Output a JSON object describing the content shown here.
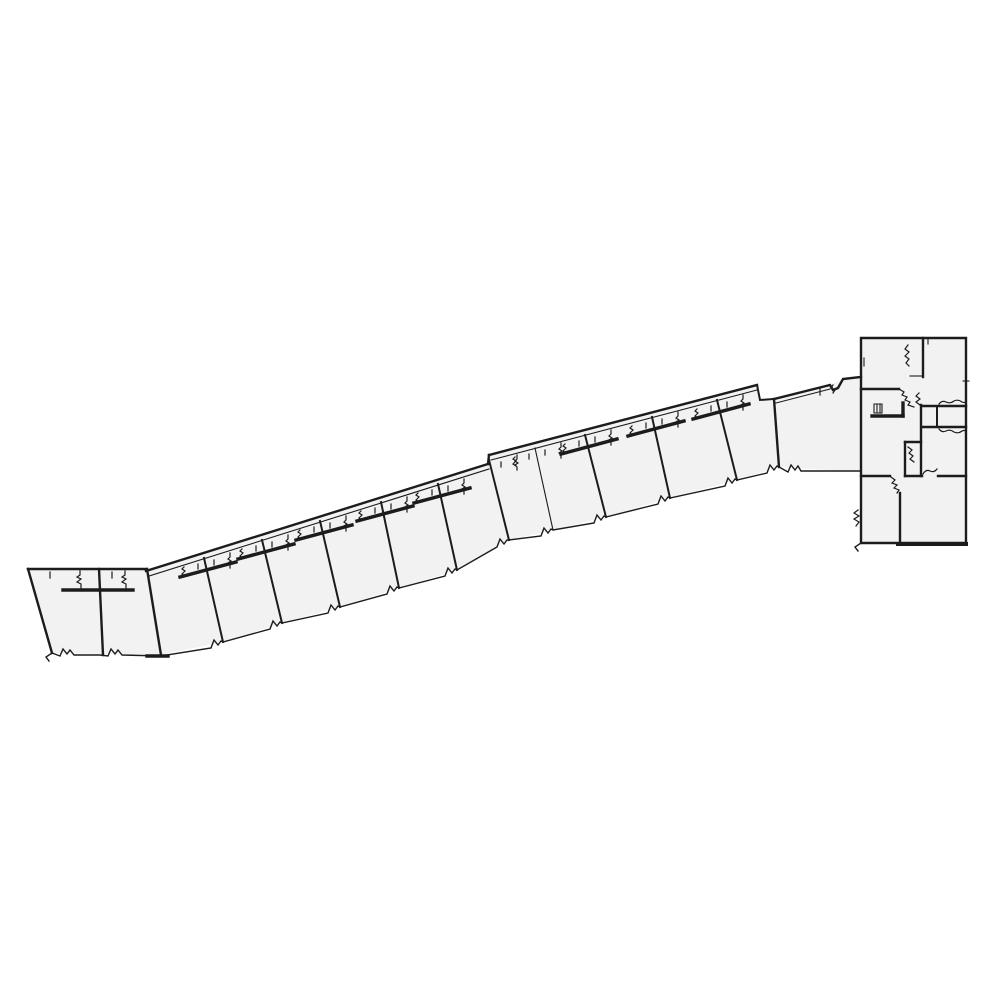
{
  "page": {
    "title": "architectural-floor-plan",
    "background": "#ffffff"
  },
  "drawing": {
    "stroke_color": "#1c1c1c",
    "fill_color": "#f2f2f2",
    "layers": [
      {
        "name": "unit-fill",
        "kind": "fill",
        "width": 0,
        "paths": [
          "M28,569 L147,569 L161,655 L52,653 Z",
          "M147,569 L488,464 L509,540 L457,570 L399,588 L340,607 L282,623 L223,642 L161,655 Z",
          "M489,455 L757,385 L760,400 L774,399 L779,467 L737,480 L670,498 L606,517 L553,530 L509,540 Z",
          "M774,399 L830,385 L843,379 L861,377 L861,472 L779,467 Z",
          "M861,338 L966,338 L966,543 L861,543 Z"
        ]
      },
      {
        "name": "outer-wall",
        "kind": "stroke",
        "width": 2.4,
        "paths": [
          "M28,569 L147,569",
          "M28,569 L52,653",
          "M147,569 L161,655",
          "M99,569 L103,655",
          "M146,571 L488,464",
          "M488,464 L489,455",
          "M489,455 L757,385",
          "M861,338 L966,338 L966,543 L861,543 Z",
          "M774,399 L830,385 L833,390 L838,388 L843,379 L861,377",
          "M774,399 L779,467",
          "M923,338 L923,377",
          "M861,389 L899,389",
          "M921,405 L921,476",
          "M923,406 L966,406",
          "M923,427 L966,427",
          "M905,442 L921,442",
          "M905,442 L905,476",
          "M861,476 L890,476",
          "M905,476 L922,476",
          "M938,476 L966,476",
          "M900,493 L900,543"
        ]
      },
      {
        "name": "partition-wall",
        "kind": "stroke",
        "width": 2.0,
        "paths": [
          "M204,558 L223,642",
          "M262,540 L282,623",
          "M320,521 L340,607",
          "M381,502 L399,588",
          "M438,484 L457,570",
          "M489,460 L509,540",
          "M585,435 L606,517",
          "M652,417 L670,498",
          "M717,400 L737,480",
          "M757,385 L760,400 L774,399",
          "M937,406 L937,427"
        ]
      },
      {
        "name": "bold-interior-wall",
        "kind": "stroke",
        "width": 3.4,
        "paths": [
          "M63,590 L133,590",
          "M180,577 L236,562",
          "M238,559 L294,544",
          "M296,540 L352,525",
          "M357,521 L413,506",
          "M414,503 L470,488",
          "M561,454 L617,439",
          "M628,436 L684,421",
          "M693,419 L749,404",
          "M872,416 L903,416",
          "M903,403 L903,416",
          "M147,656 L168,656"
        ]
      },
      {
        "name": "thin-line",
        "kind": "stroke",
        "width": 1.1,
        "paths": [
          "M149,576 L489,469",
          "M491,460 L757,390",
          "M776,403 L830,389",
          "M535,448 L553,530",
          "M910,376 L923,376",
          "M874,404 L882,404 L882,413 L874,413 Z",
          "M877,404 L877,413",
          "M880,404 L880,413",
          "M963,381 L969,381",
          "M928,339 L928,344",
          "M864,358 L864,366"
        ]
      },
      {
        "name": "perimeter-zigzag",
        "kind": "stroke",
        "width": 1.4,
        "paths": [
          "M52,653 L60,656 L63,649 L67,654 L70,650 L74,655 L100,655 L108,656 L111,649 L115,654 L118,650 L122,655 L161,656",
          "M52,653 L46,657 L49,661",
          "M161,656 L211,648 L214,640 L218,645 L221,641 L223,642 L270,629 L273,621 L277,626 L280,622 L282,623 L328,613 L331,605 L335,610 L338,606 L340,607 L387,594 L390,586 L394,591 L397,587 L399,588 L445,576 L448,568 L452,573 L455,569 L457,570 L497,547 L500,539 L504,544 L507,540 L509,540",
          "M509,540 L541,536 L544,528 L548,533 L551,529 L553,530 L594,523 L597,515 L601,520 L604,516 L606,517 L658,504 L661,496 L665,501 L668,497 L670,498 L725,486 L728,478 L732,483 L735,479 L737,480 L767,473 L770,465 L774,470 L777,466 L779,467",
          "M779,467 L788,472 L791,465 L795,470 L798,466 L801,471 L861,471",
          "M861,543 L855,547 L858,551"
        ]
      },
      {
        "name": "door-squiggle",
        "kind": "stroke",
        "width": 1.2,
        "paths": [
          "M50,572 l0,6",
          "M80,571 l0,4 l-3,2 l4,2 l-4,3 l4,2 l0,4",
          "M112,572 l0,6",
          "M125,571 l0,4 l-3,2 l4,2 l-4,3 l4,2 l0,4",
          "M184,567 l-2,2 l3,2 l-3,3 l3,2",
          "M198,564 l0,5",
          "M214,560 l0,5",
          "M230,553 l0,4 l-2,2 l3,2 l-3,2 l2,2 l0,3",
          "M242,549 l-2,2 l3,2 l-3,3 l3,2",
          "M256,546 l0,5",
          "M272,542 l0,5",
          "M288,535 l0,4 l-2,2 l3,2 l-3,2 l2,2 l0,3",
          "M300,530 l-2,2 l3,2 l-3,3 l3,2",
          "M314,527 l0,5",
          "M330,523 l0,5",
          "M346,516 l0,4 l-2,2 l3,2 l-3,2 l2,2 l0,3",
          "M361,511 l-2,2 l3,2 l-3,3 l3,2",
          "M375,508 l0,5",
          "M391,504 l0,5",
          "M407,497 l0,4 l-2,2 l3,2 l-3,2 l2,2 l0,3",
          "M418,493 l-2,2 l3,2 l-3,3 l3,2",
          "M432,490 l0,5",
          "M448,486 l0,5",
          "M464,479 l0,4 l-2,2 l3,2 l-3,2 l2,2 l0,3",
          "M501,462 l0,5",
          "M517,455 l0,4 l-2,2 l3,2 l-3,2 l2,2 l0,3",
          "M515,457 l-2,2 l3,2 l-3,3 l3,2",
          "M529,454 l0,5",
          "M545,450 l0,5",
          "M561,443 l0,4 l-2,2 l3,2 l-3,2 l2,2 l0,3",
          "M565,444 l-2,2 l3,2 l-3,3 l3,2",
          "M579,441 l0,5",
          "M595,437 l0,5",
          "M611,430 l0,4 l-2,2 l3,2 l-3,2 l2,2 l0,3",
          "M632,426 l-2,2 l3,2 l-3,3 l3,2",
          "M646,423 l0,5",
          "M662,419 l0,5",
          "M678,412 l0,4 l-2,2 l3,2 l-3,2 l2,2 l0,3",
          "M697,409 l-2,2 l3,2 l-3,3 l3,2",
          "M711,406 l0,5",
          "M727,402 l0,5",
          "M743,395 l0,4 l-2,2 l3,2 l-3,2 l2,2 l0,3",
          "M820,389 l0,6",
          "M833,385 l-2,3 l4,2 l-2,3",
          "M908,345 l-3,4 l4,3 l-4,4 l4,3 l-3,4 l3,3",
          "M899,389 l5,3 l-2,3 l5,2 l-2,3 l5,2 l-2,3 l6,2",
          "M919,393 l-3,3 l4,3 l-4,3 l4,3",
          "M939,404 q3,-4 7,-2 q4,2 8,-1 q4,-2 8,1 q2,1 4,0",
          "M939,429 q3,4 7,2 q4,-2 8,1 q4,2 8,-1 q2,-1 4,0",
          "M908,447 l4,3 l-3,3 l4,3 l-3,3 l4,3",
          "M891,477 l4,3 l-3,3 l5,2 l-3,3 l5,2 l-2,3",
          "M923,474 q3,-5 7,-3 q4,2 7,-2",
          "M858,510 l-4,3 l5,3 l-5,3 l5,3 l-3,4"
        ]
      },
      {
        "name": "heavy-base-wall",
        "kind": "stroke",
        "width": 4.0,
        "paths": [
          "M898,544 L966,544"
        ]
      }
    ]
  }
}
